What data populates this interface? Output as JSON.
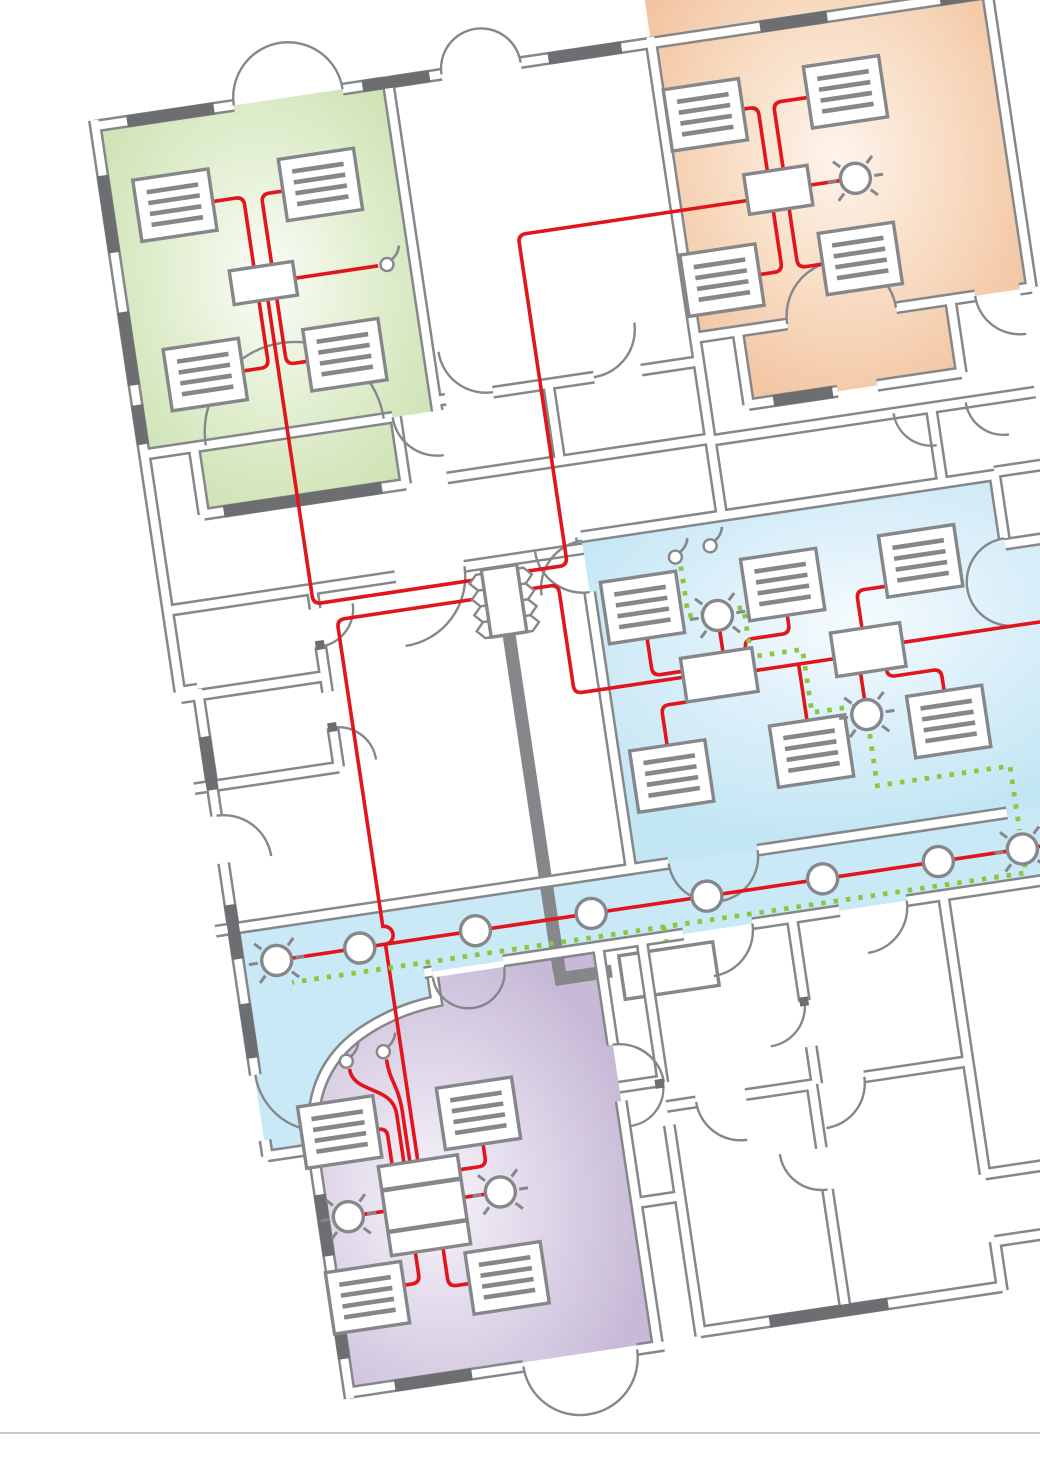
{
  "page": {
    "background": "#ffffff",
    "footer_divider_color": "#c6c8ca"
  },
  "colors": {
    "wall": "#85878a",
    "wall_dark": "#6d6e71",
    "wire_red": "#e2151d",
    "wire_green": "#8cc63e",
    "divider": "#c6c8ca",
    "room_green_center": "#fbfdf8",
    "room_green_mid": "#e3efd2",
    "room_green_edge": "#c9dfab",
    "room_orange_center": "#fef4ec",
    "room_orange_mid": "#f8ddc4",
    "room_orange_edge": "#f1bd97",
    "room_blue_center": "#f6fbfe",
    "room_blue_mid": "#ddf0fa",
    "room_blue_edge": "#c3e6f4",
    "corridor_fill": "#c9e9f6",
    "room_purple_center": "#f7f4fa",
    "room_purple_mid": "#e2daeb",
    "room_purple_edge": "#c7bad7"
  },
  "plan": {
    "type": "building-floorplan-heating-wiring-diagram",
    "rotation_deg": -8.5,
    "zones": [
      {
        "id": "office-green",
        "color_edge": "#c9dfab",
        "radiators": 4,
        "controllers": 1,
        "sensors": 1,
        "lamps": 0
      },
      {
        "id": "office-orange",
        "color_edge": "#f1bd97",
        "radiators": 4,
        "controllers": 1,
        "sensors": 0,
        "lamps": 1
      },
      {
        "id": "open-office-blue",
        "color_edge": "#c3e6f4",
        "radiators": 6,
        "controllers": 2,
        "sensors": 2,
        "lamps": 2
      },
      {
        "id": "office-purple",
        "color_edge": "#c7bad7",
        "radiators": 4,
        "controllers": 1,
        "sensors": 2,
        "lamps": 2
      },
      {
        "id": "corridor",
        "color_edge": "#c9e9f6",
        "ceiling_lights": 6,
        "end_lamps": 2
      }
    ],
    "distribution": {
      "manifold_ports": 8,
      "trunk_lines": 1
    },
    "wiring": {
      "red_circuits": "controllers-radiators-lamps",
      "green_dotted": "sensor-daisy-chain"
    }
  }
}
